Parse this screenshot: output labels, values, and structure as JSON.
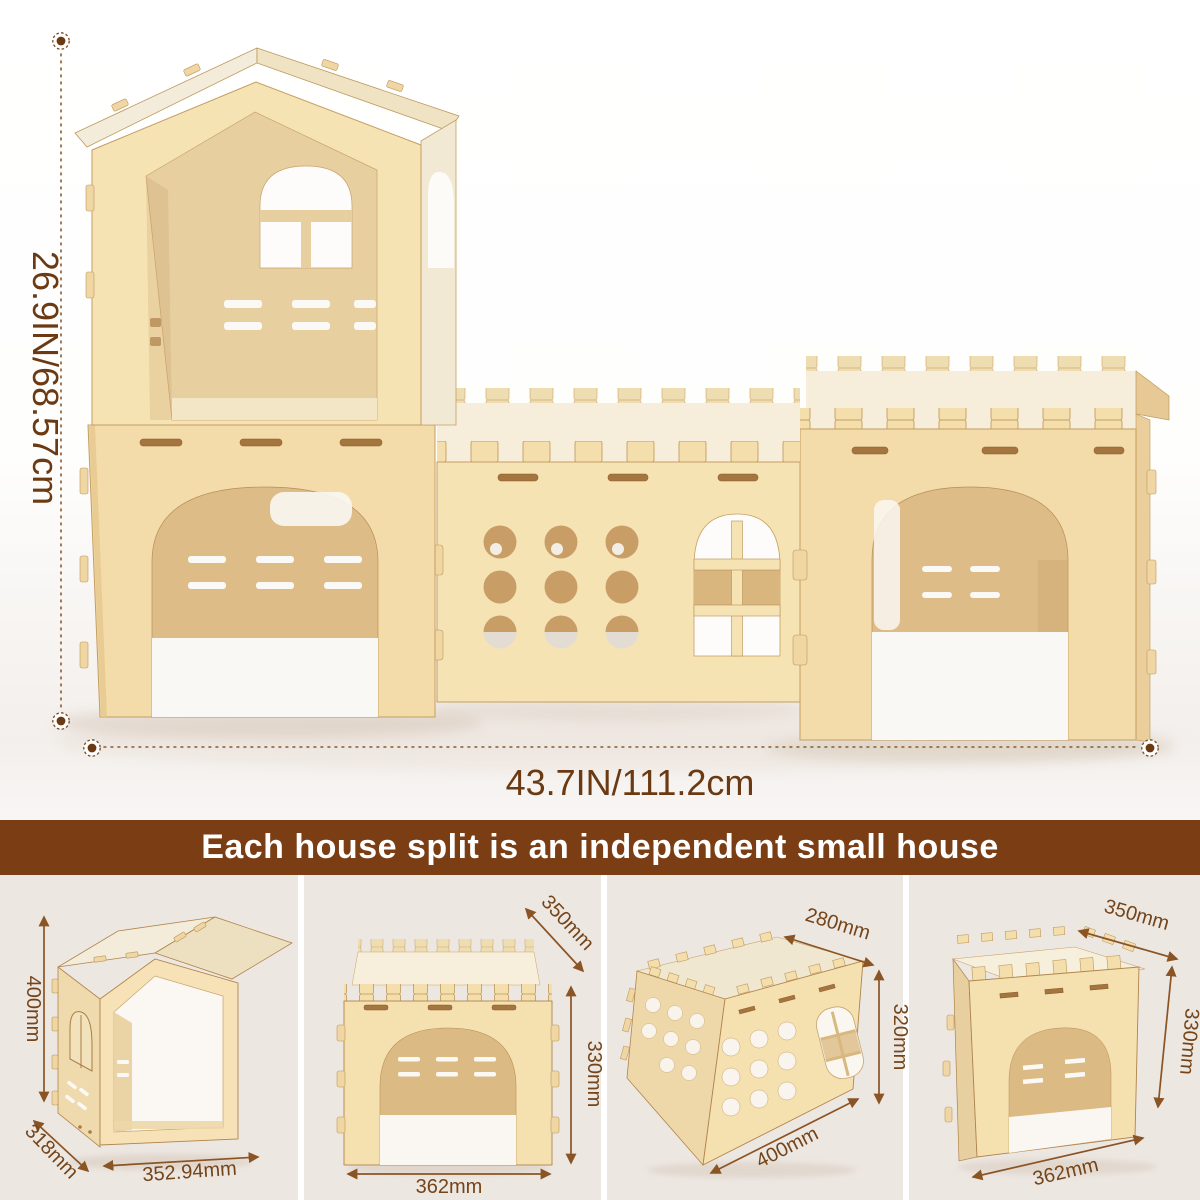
{
  "main_figure": {
    "height_label": "26.9IN/68.57cm",
    "width_label": "43.7IN/111.2cm"
  },
  "banner": {
    "text": "Each house split is an independent small house"
  },
  "panels": [
    {
      "name": "gable-house",
      "dim_height": "400mm",
      "dim_depth": "318mm",
      "dim_width": "352.94mm"
    },
    {
      "name": "castle-tower-front-view",
      "dim_depth": "350mm",
      "dim_height": "330mm",
      "dim_width": "362mm"
    },
    {
      "name": "middle-passage-section",
      "dim_depth": "280mm",
      "dim_height": "320mm",
      "dim_width": "400mm"
    },
    {
      "name": "castle-tower-angled-view",
      "dim_depth": "350mm",
      "dim_height": "330mm",
      "dim_width": "362mm"
    }
  ],
  "colors": {
    "banner_bg": "#7B3E14",
    "banner_text": "#FFFFFF",
    "panel_bg": "#EDE7E2",
    "dim_main": "#6B3A12",
    "dim_panel": "#74451A",
    "dim_line": "#8A5A2F",
    "arrow": "#8A5425",
    "wood_light": "#F3DCA9",
    "wood_bright": "#F6E3B4",
    "wood_interior": "#DEBC88",
    "wood_edge": "#C49E62"
  }
}
